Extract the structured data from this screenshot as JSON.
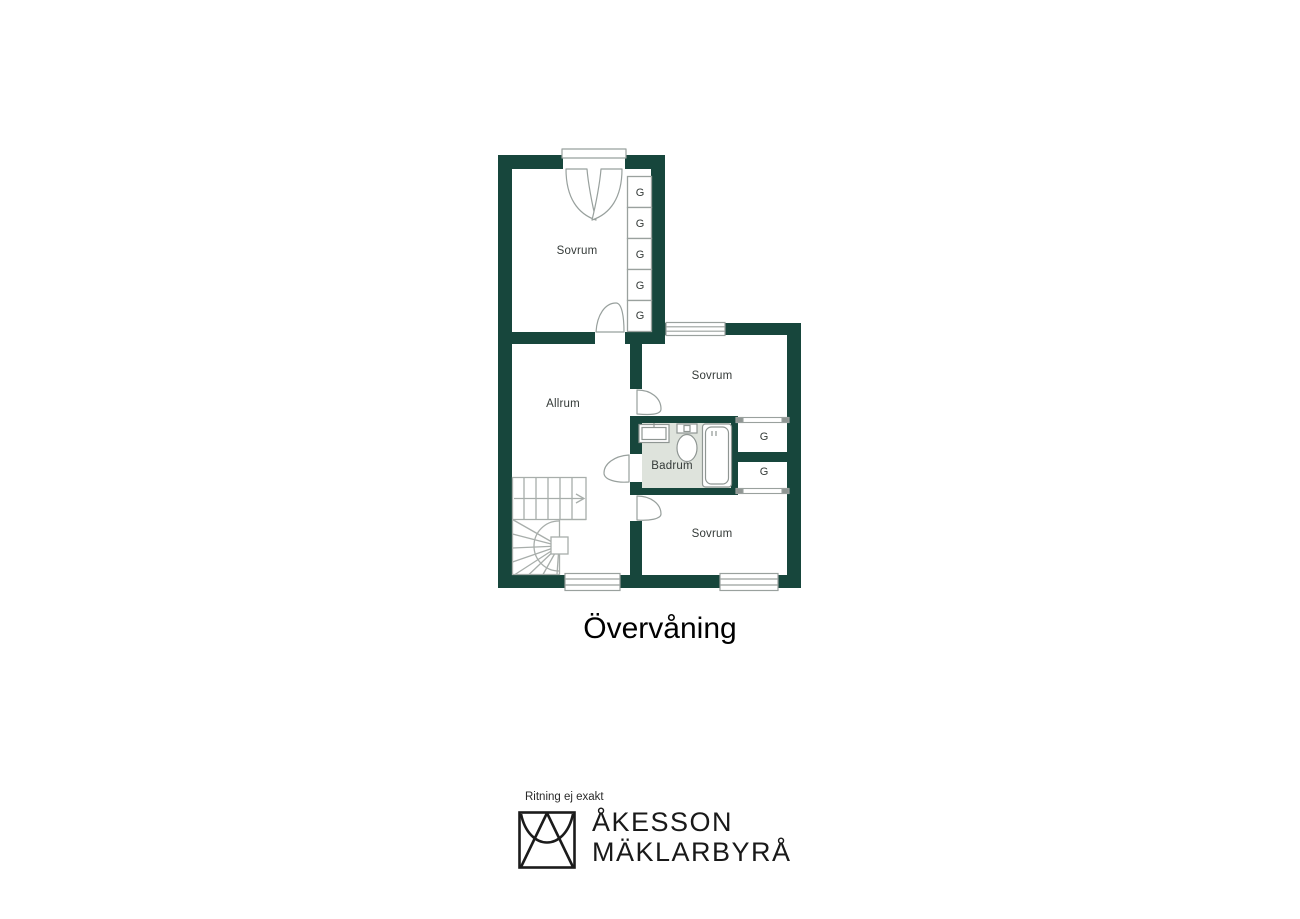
{
  "floor_plan": {
    "title": "Övervåning",
    "rooms": [
      {
        "id": "sovrum-top",
        "label": "Sovrum"
      },
      {
        "id": "allrum",
        "label": "Allrum"
      },
      {
        "id": "sovrum-right",
        "label": "Sovrum"
      },
      {
        "id": "badrum",
        "label": "Badrum"
      },
      {
        "id": "sovrum-bottom",
        "label": "Sovrum"
      }
    ],
    "wardrobes": {
      "column": [
        "G",
        "G",
        "G",
        "G",
        "G"
      ],
      "right": [
        "G",
        "G"
      ]
    },
    "fixtures": [
      "sink",
      "toilet",
      "bathtub",
      "staircase"
    ],
    "colors": {
      "wall": "#17463c",
      "bathroom_floor": "#dee3dc",
      "line_gray": "#9aa19e",
      "stair_gray": "#a8aeab",
      "label_text": "#343a38"
    }
  },
  "footer": {
    "disclaimer": "Ritning ej exakt",
    "brand_line1": "ÅKESSON",
    "brand_line2": "MÄKLARBYRÅ"
  }
}
